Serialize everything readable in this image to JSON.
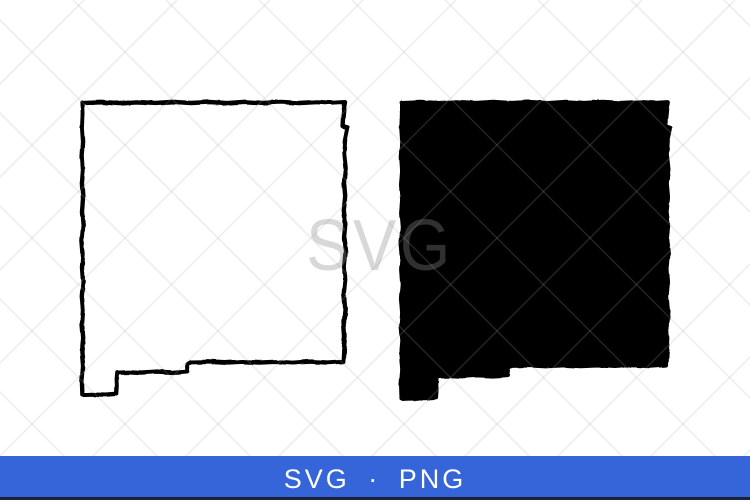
{
  "page": {
    "background_color": "#ffffff"
  },
  "graphics": {
    "left_map": {
      "icon": "new-mexico-outline-map",
      "style": "outline",
      "color": "#000000"
    },
    "right_map": {
      "icon": "new-mexico-filled-map",
      "style": "filled",
      "color": "#000000"
    }
  },
  "watermark": {
    "text": "SVG",
    "pattern": "diagonal-crosshatch",
    "text_color": "#8c8c8c",
    "line_color": "#a7a7a7"
  },
  "footer": {
    "label": "SVG · PNG",
    "background_color": "#3565d8",
    "edge_color": "#1b2436",
    "text_color": "#ffffff"
  }
}
